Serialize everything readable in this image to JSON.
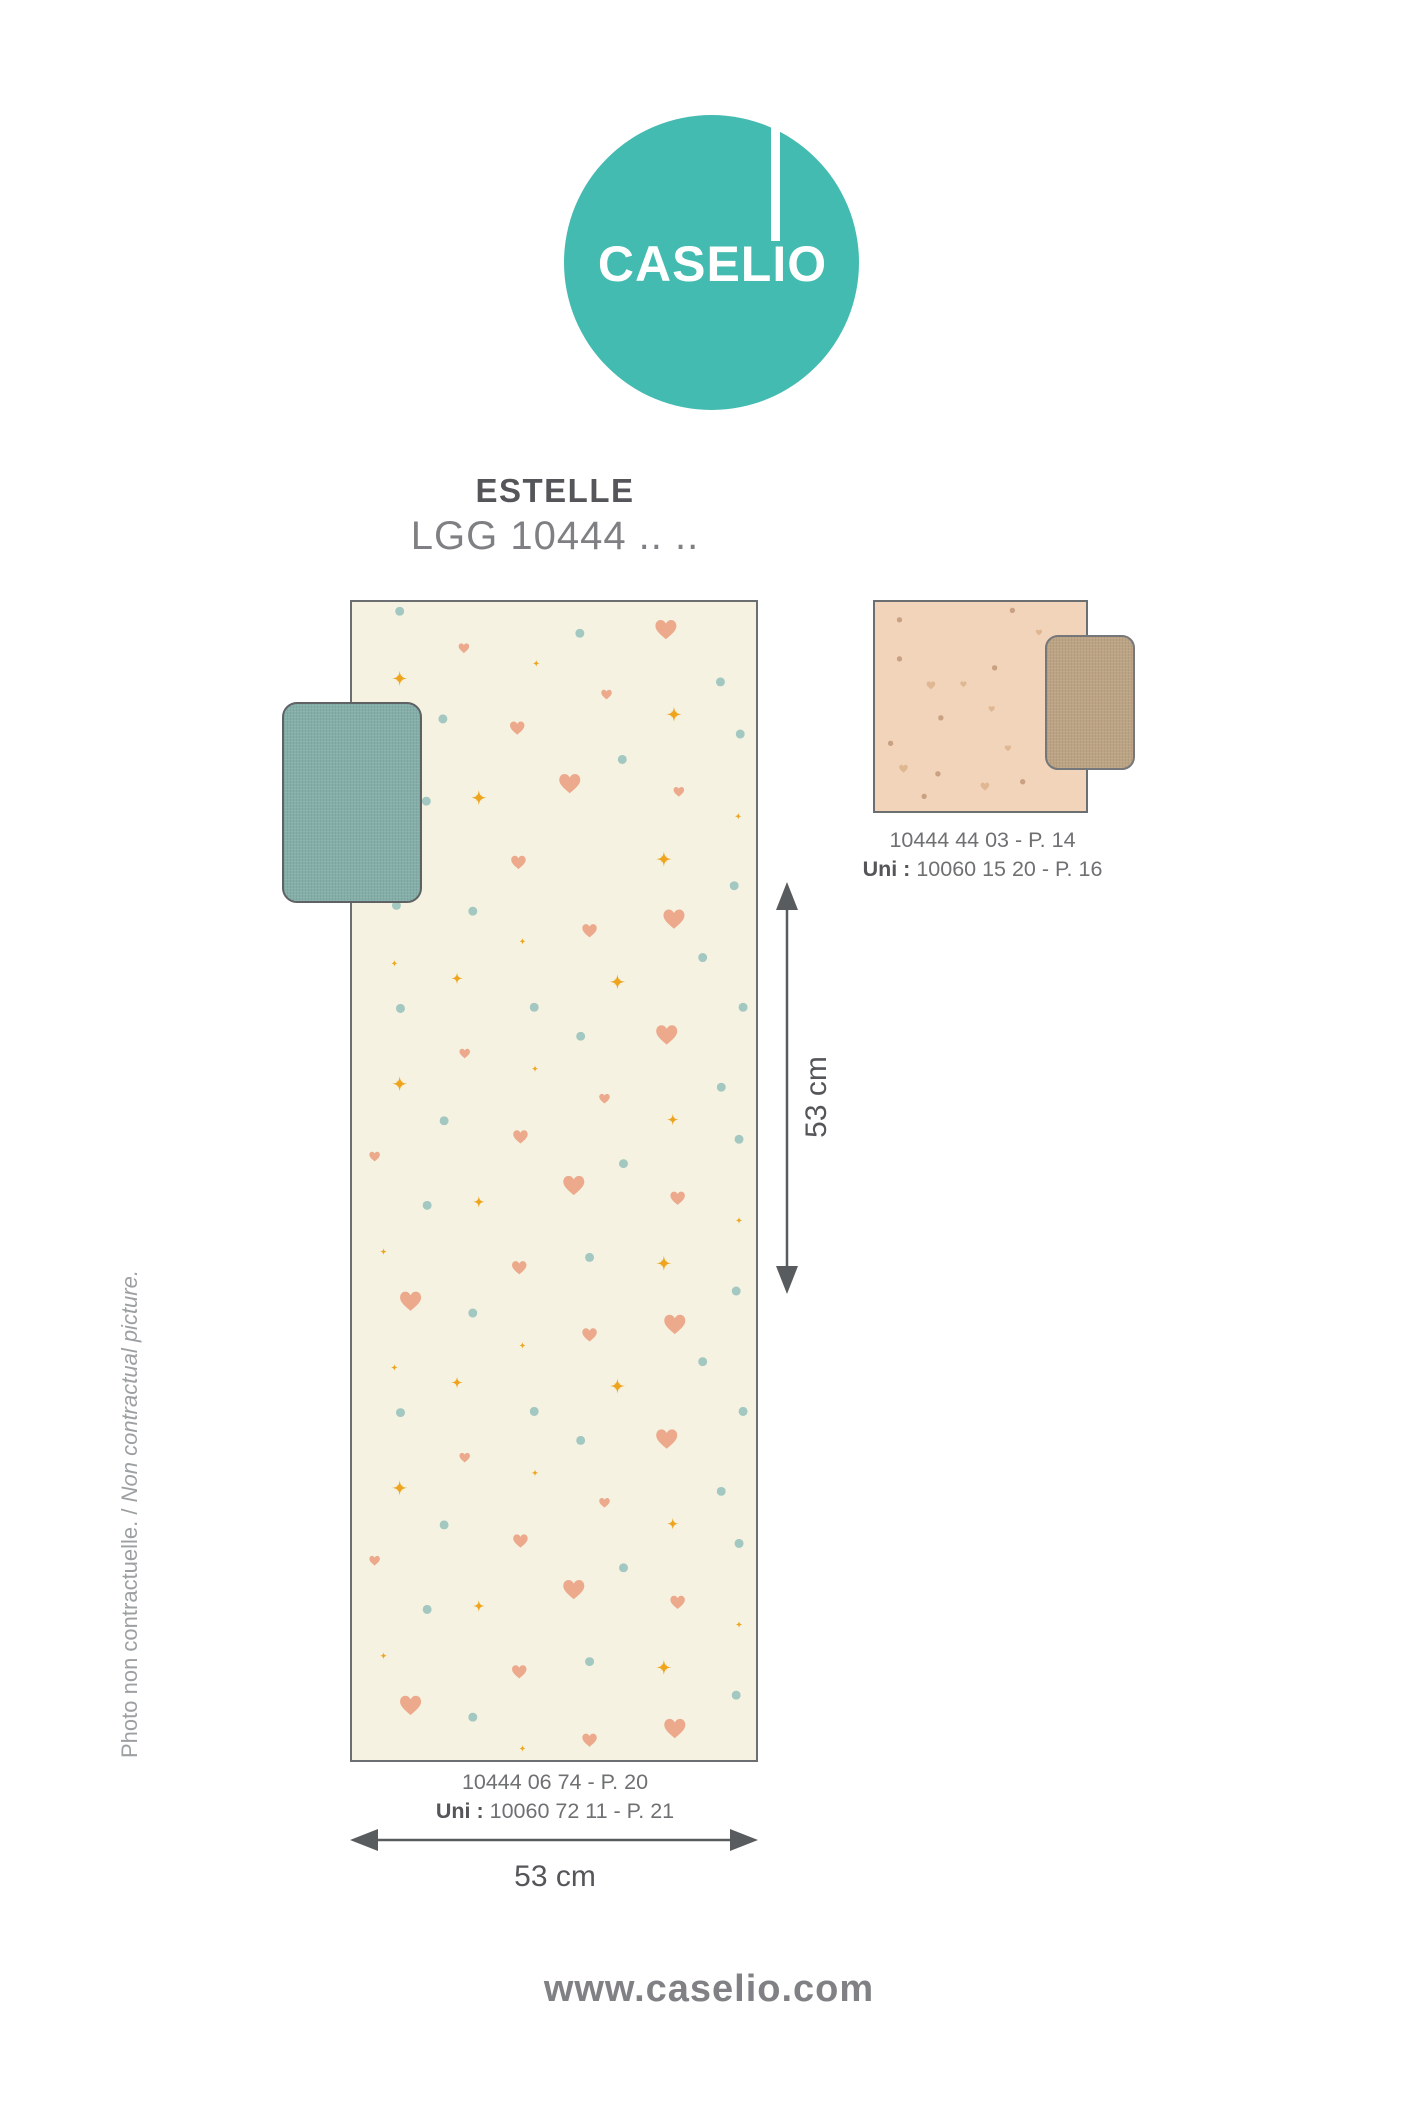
{
  "logo": {
    "brand": "CASELIO",
    "circle_color": "#43BBB1",
    "text_color": "#FFFFFF"
  },
  "header": {
    "collection_name": "ESTELLE",
    "reference_line": "LGG 10444 .. .."
  },
  "main_sample": {
    "bg": "#F5F2E1",
    "swatch_color": "#84AEA8",
    "pattern_colors": {
      "heart": "#ECA98C",
      "dot": "#A3C8C1",
      "star": "#EEA41C"
    },
    "code_line": "10444 06 74 - P. 20",
    "uni_label": "Uni :",
    "uni_value": " 10060 72 11 - P. 21",
    "motifs": [
      [
        "d",
        11.8,
        0.8
      ],
      [
        "hs",
        27.7,
        4.0
      ],
      [
        "d",
        56.4,
        2.7
      ],
      [
        "hb",
        77.7,
        2.4
      ],
      [
        "s8",
        11.8,
        6.6
      ],
      [
        "p",
        45.6,
        5.3
      ],
      [
        "hs",
        63.0,
        8.0
      ],
      [
        "d",
        91.2,
        6.9
      ],
      [
        "hm",
        40.9,
        10.9
      ],
      [
        "s8",
        79.7,
        9.7
      ],
      [
        "d",
        96.1,
        11.4
      ],
      [
        "d",
        66.9,
        13.6
      ],
      [
        "hs",
        80.9,
        16.4
      ],
      [
        "p",
        95.6,
        18.5
      ],
      [
        "s8",
        77.2,
        22.2
      ],
      [
        "d",
        94.6,
        24.5
      ],
      [
        "s8",
        31.4,
        16.9
      ],
      [
        "hm",
        41.2,
        22.5
      ],
      [
        "d",
        11.0,
        26.2
      ],
      [
        "hb",
        53.9,
        15.7
      ],
      [
        "d",
        22.5,
        10.1
      ],
      [
        "d",
        18.4,
        17.2
      ],
      [
        "d",
        29.9,
        26.7
      ],
      [
        "hm",
        58.8,
        28.4
      ],
      [
        "hb",
        79.7,
        27.4
      ],
      [
        "p",
        42.2,
        29.3
      ],
      [
        "p",
        10.5,
        31.2
      ],
      [
        "s4",
        26.0,
        32.5
      ],
      [
        "s8",
        65.7,
        32.8
      ],
      [
        "d",
        12.0,
        35.1
      ],
      [
        "d",
        45.1,
        35.0
      ],
      [
        "d",
        86.8,
        30.7
      ],
      [
        "d",
        96.8,
        35.0
      ],
      [
        "hb",
        77.9,
        37.4
      ],
      [
        "d",
        56.6,
        37.5
      ],
      [
        "hs",
        27.9,
        39.0
      ],
      [
        "p",
        45.3,
        40.3
      ],
      [
        "s8",
        11.8,
        41.6
      ],
      [
        "hs",
        62.5,
        42.9
      ],
      [
        "d",
        91.4,
        41.9
      ],
      [
        "s4",
        79.4,
        44.7
      ],
      [
        "d",
        22.8,
        44.8
      ],
      [
        "d",
        95.8,
        46.4
      ],
      [
        "hm",
        41.7,
        46.2
      ],
      [
        "hs",
        5.6,
        47.9
      ],
      [
        "d",
        67.2,
        48.5
      ],
      [
        "hb",
        54.9,
        50.4
      ],
      [
        "hm",
        80.6,
        51.5
      ],
      [
        "s4",
        31.4,
        51.8
      ],
      [
        "d",
        18.6,
        52.1
      ],
      [
        "p",
        95.8,
        53.4
      ],
      [
        "p",
        7.8,
        56.1
      ],
      [
        "d",
        58.8,
        56.6
      ],
      [
        "hm",
        41.4,
        57.5
      ],
      [
        "s8",
        77.2,
        57.1
      ],
      [
        "d",
        95.1,
        59.5
      ],
      [
        "hb",
        14.5,
        60.4
      ],
      [
        "d",
        29.9,
        61.4
      ],
      [
        "hb",
        79.9,
        62.4
      ],
      [
        "hm",
        58.8,
        63.3
      ],
      [
        "p",
        42.2,
        64.2
      ],
      [
        "p",
        10.5,
        66.1
      ],
      [
        "s4",
        26.0,
        67.4
      ],
      [
        "s8",
        65.7,
        67.7
      ],
      [
        "d",
        12.0,
        70.0
      ],
      [
        "d",
        45.1,
        69.9
      ],
      [
        "d",
        86.8,
        65.6
      ],
      [
        "d",
        96.8,
        69.9
      ],
      [
        "hb",
        77.9,
        72.3
      ],
      [
        "d",
        56.6,
        72.4
      ],
      [
        "hs",
        27.9,
        73.9
      ],
      [
        "p",
        45.3,
        75.2
      ],
      [
        "s8",
        11.8,
        76.5
      ],
      [
        "hs",
        62.5,
        77.8
      ],
      [
        "d",
        91.4,
        76.8
      ],
      [
        "s4",
        79.4,
        79.6
      ],
      [
        "d",
        22.8,
        79.7
      ],
      [
        "d",
        95.8,
        81.3
      ],
      [
        "hm",
        41.7,
        81.1
      ],
      [
        "hs",
        5.6,
        82.8
      ],
      [
        "d",
        67.2,
        83.4
      ],
      [
        "hb",
        54.9,
        85.3
      ],
      [
        "hm",
        80.6,
        86.4
      ],
      [
        "s4",
        31.4,
        86.7
      ],
      [
        "d",
        18.6,
        87.0
      ],
      [
        "p",
        95.8,
        88.3
      ],
      [
        "p",
        7.8,
        91.0
      ],
      [
        "d",
        58.8,
        91.5
      ],
      [
        "hm",
        41.4,
        92.4
      ],
      [
        "s8",
        77.2,
        92.0
      ],
      [
        "d",
        95.1,
        94.4
      ],
      [
        "hb",
        14.5,
        95.3
      ],
      [
        "d",
        29.9,
        96.3
      ],
      [
        "hb",
        79.9,
        97.3
      ],
      [
        "p",
        42.2,
        99.0
      ],
      [
        "hm",
        58.8,
        98.3
      ]
    ]
  },
  "side_sample": {
    "bg": "#F2D4BA",
    "swatch_color": "#BBA383",
    "pattern_colors": {
      "heart": "#DFB893",
      "dot": "#C9A183",
      "star": "#C9A183"
    },
    "code_line": "10444 44 03 - P. 14",
    "uni_label": "Uni :",
    "uni_value": " 10060 15 20 - P. 16",
    "motifs": [
      [
        "d",
        11.6,
        8.5
      ],
      [
        "d",
        65.1,
        4.0
      ],
      [
        "hs",
        77.7,
        14.6
      ],
      [
        "d",
        83.0,
        20.0
      ],
      [
        "d",
        11.6,
        27.2
      ],
      [
        "d",
        56.7,
        31.5
      ],
      [
        "hm",
        26.5,
        39.9
      ],
      [
        "hs",
        41.9,
        39.4
      ],
      [
        "d",
        90.2,
        44.1
      ],
      [
        "hs",
        55.3,
        51.2
      ],
      [
        "d",
        31.2,
        55.4
      ],
      [
        "d",
        7.4,
        67.6
      ],
      [
        "hs",
        63.0,
        70.0
      ],
      [
        "hm",
        13.5,
        79.8
      ],
      [
        "d",
        29.8,
        82.2
      ],
      [
        "hm",
        52.1,
        88.3
      ],
      [
        "d",
        70.0,
        86.0
      ],
      [
        "d",
        23.3,
        93.0
      ]
    ]
  },
  "dimensions": {
    "height_label": "53 cm",
    "width_label": "53 cm"
  },
  "side_note": {
    "fr": "Photo non contractuelle. / ",
    "en": "Non contractual picture."
  },
  "footer": {
    "website": "www.caselio.com"
  }
}
